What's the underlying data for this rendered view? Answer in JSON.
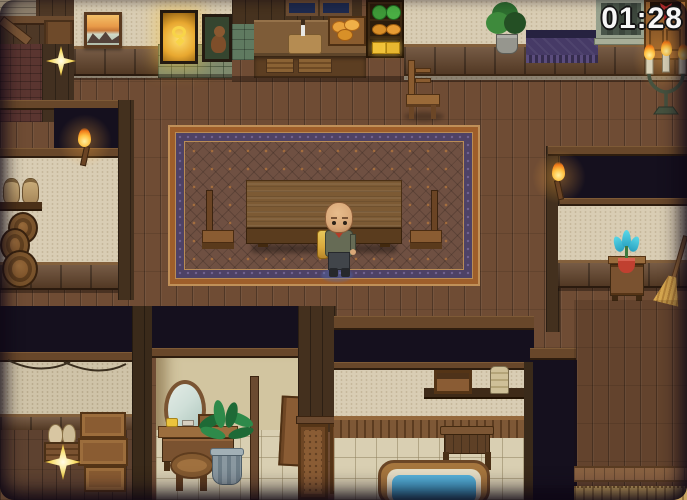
{
  "hud": {
    "timer": "01:28"
  },
  "scene": {
    "name": "inn-interior",
    "objects": [
      "painting",
      "jewelry-display-case",
      "trophy-display-case",
      "kitchen-counter",
      "cutting-board",
      "bread-crate",
      "produce-shelf",
      "kitchen-windows",
      "wooden-chair",
      "potted-plant",
      "purple-cloth-bench",
      "stone-door",
      "cabinet",
      "candelabra",
      "patterned-carpet",
      "long-table",
      "stool-left",
      "stool-right",
      "player-character",
      "held-bread",
      "storeroom-sacks",
      "storeroom-barrels",
      "wall-torch-left",
      "wall-torch-right",
      "nightstand",
      "flower-vase",
      "broom",
      "jug-crate",
      "stacked-crates",
      "sparkle-top-left",
      "sparkle-bottom-left",
      "vanity-mirror",
      "vanity-table",
      "vanity-stool",
      "indoor-plant",
      "wooden-screen",
      "bathroom-shelf",
      "towel-stand",
      "bathtub",
      "floor-mat"
    ]
  },
  "palette": {
    "floor": "#6f4c34",
    "wall": "#d9cdb4",
    "carpet_field": "#6f5042",
    "carpet_border": "#4e4266",
    "carpet_trim": "#9e5e2a",
    "timer_color": "#f6f6f6",
    "flame": "#f5a028",
    "water": "#3494c4"
  }
}
